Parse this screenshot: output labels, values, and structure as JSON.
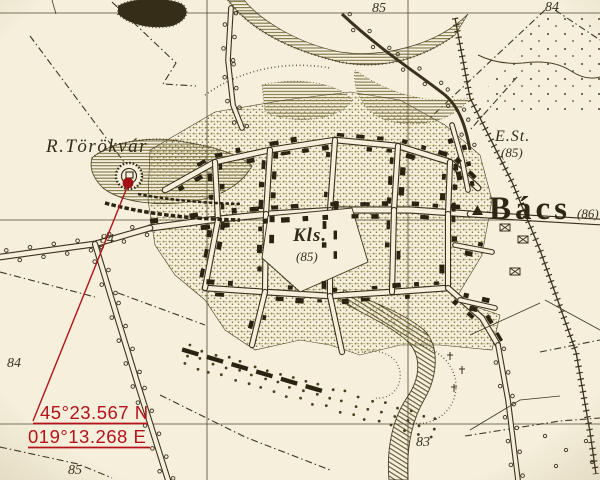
{
  "map": {
    "colors": {
      "paper": "#f5efdb",
      "ink": "#3b321d",
      "building": "#2a2312",
      "stipple": "#8f854c",
      "marker_red": "#b5121b"
    },
    "labels": {
      "ruin": "R.Törökvár",
      "town": "Bács",
      "town_elevation": "(86)",
      "station": "E.St.",
      "station_elevation": "(85)",
      "monastery": "Kls.",
      "monastery_elevation": "(85)"
    },
    "spot_heights": [
      {
        "value": "85"
      },
      {
        "value": "84"
      },
      {
        "value": "84"
      },
      {
        "value": "84"
      },
      {
        "value": "83"
      },
      {
        "value": "85"
      }
    ],
    "marker": {
      "latitude": "45°23.567 N",
      "longitude": "019°13.268 E"
    }
  }
}
